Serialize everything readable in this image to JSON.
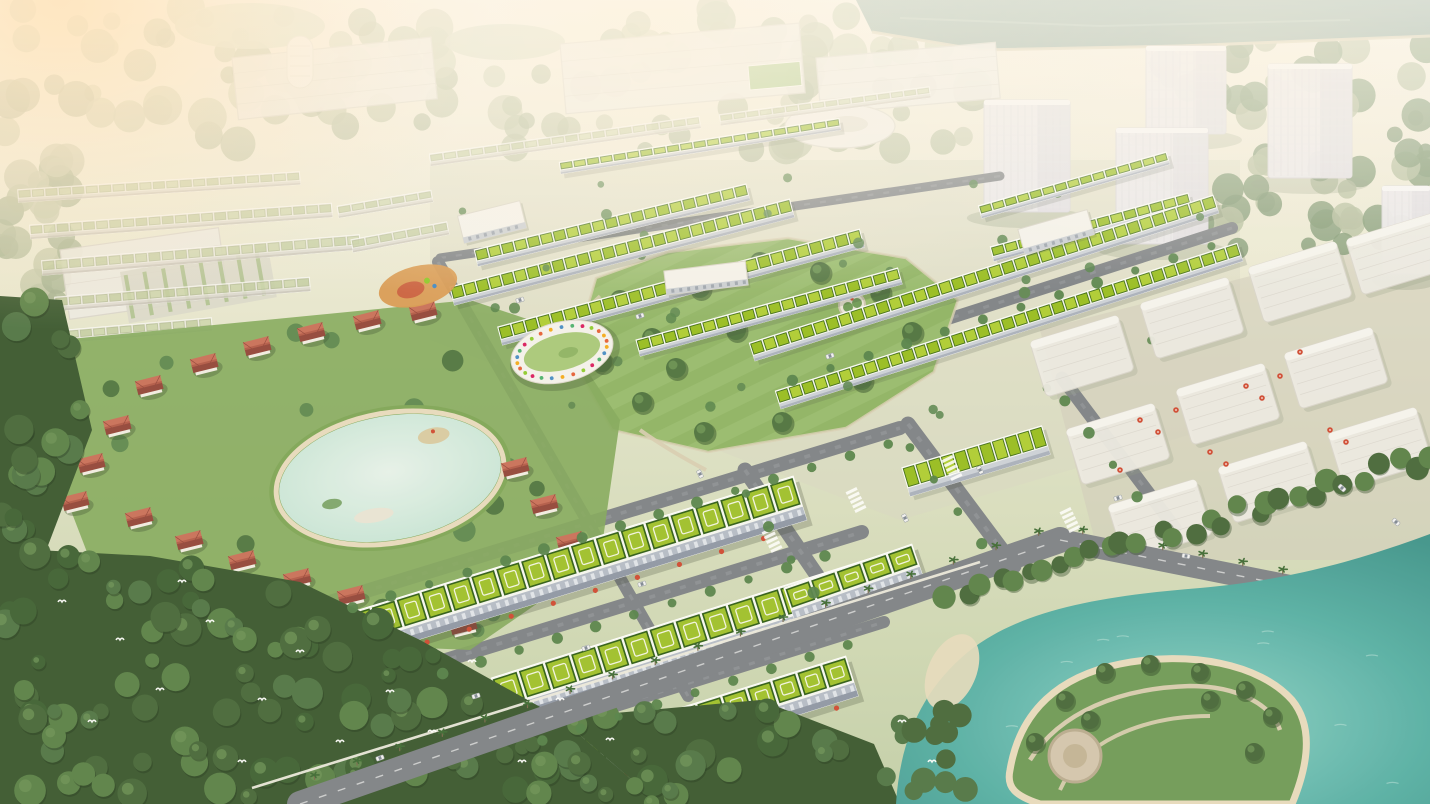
{
  "scene": {
    "title": "Aerial 3D masterplan rendering of a green township development",
    "lighting": "hazy warm sunlight from upper left",
    "palette": {
      "sky_top": "#f6efe0",
      "ground_a": "#e9e8d2",
      "ground_b": "#d5dcbc",
      "ground_c": "#c3cfa9",
      "haze_warm": "#ffe3ba",
      "haze_soft": "#fff2da",
      "river": "#87a497",
      "river_bank": "#d9cdb2",
      "canopy_wash_a": "#c3c8ab",
      "canopy_wash_b": "#b2bc9c",
      "canopy_wash_c": "#a4b292",
      "ghost_fill": "#edebe5",
      "ghost_edge": "#d9d5cd",
      "tower_fill": "#ebe9ed",
      "tower_edge": "#d8d6db",
      "tower_shade": "#dedce2",
      "roof_green_light": "#aecd33",
      "roof_green": "#97bd20",
      "roof_green_dark": "#3f6d15",
      "roof_deck": "#f6f7f2",
      "facade": "#ccd1d9",
      "facade_dark": "#a9b0bd",
      "mega_roof": "#9fc02c",
      "mega_roof_dark": "#2f5d17",
      "mega_facade": "#b5bcc8",
      "mega_facade_dark": "#8f97a6",
      "villa_roof": "#b35b49",
      "villa_roof_light": "#c9705a",
      "villa_roof_dark": "#93463a",
      "villa_wall": "#f1ece3",
      "lawn": "#8fb465",
      "lawn_light": "#9cc074",
      "park_tree": "#4e7340",
      "tree_mid": "#55824a",
      "forest_base": "#3a5830",
      "forest_mid": "#47683a",
      "forest_light": "#5a8148",
      "pond_light": "#e6f2ea",
      "pond": "#c2e2d4",
      "lake_light": "#8ed2c8",
      "lake": "#57b0a6",
      "lake_deep": "#3f948c",
      "beach": "#e7dbbe",
      "road": "#7e8287",
      "road_light": "#979ba0",
      "path": "#d8cdb2",
      "wall": "#eceade",
      "umbrella": "#cf4a33",
      "car_light": "#f2f2f2",
      "bird": "#ffffff",
      "kindergarten_ring": [
        "#e4572e",
        "#f3a712",
        "#3f88c5",
        "#44af69",
        "#d81159",
        "#8ac926"
      ]
    },
    "river": {
      "points": [
        [
          856,
          0
        ],
        [
          1430,
          0
        ],
        [
          1430,
          36
        ],
        [
          1180,
          46
        ],
        [
          980,
          50
        ],
        [
          872,
          32
        ]
      ]
    },
    "top_left_ponds": [
      [
        250,
        26,
        150,
        46
      ],
      [
        505,
        42,
        120,
        36
      ]
    ],
    "ghost_campus": [
      {
        "x": 232,
        "y": 58,
        "w": 200,
        "h": 62,
        "angle": -6
      },
      {
        "x": 560,
        "y": 44,
        "w": 240,
        "h": 70,
        "angle": -5
      },
      {
        "x": 816,
        "y": 58,
        "w": 180,
        "h": 56,
        "angle": -5
      },
      {
        "x": 60,
        "y": 250,
        "w": 160,
        "h": 70,
        "angle": -8
      }
    ],
    "sports_field": {
      "x": 748,
      "y": 66,
      "w": 52,
      "h": 24,
      "angle": -5
    },
    "curved_building": {
      "cx": 840,
      "cy": 126,
      "rx": 55,
      "ry": 22
    },
    "round_tower": {
      "x": 287,
      "y": 36,
      "w": 26,
      "h": 52
    },
    "parking_lot": {
      "x": 120,
      "y": 272,
      "w": 150,
      "h": 52,
      "angle": -10
    },
    "ghost_towers": [
      [
        984,
        100,
        86,
        112
      ],
      [
        1146,
        46,
        80,
        88
      ],
      [
        1116,
        128,
        92,
        116
      ],
      [
        1268,
        64,
        84,
        114
      ],
      [
        1382,
        186,
        48,
        88
      ]
    ],
    "ghost_rows": [
      [
        18,
        196,
        300,
        178,
        13
      ],
      [
        30,
        232,
        332,
        210,
        14
      ],
      [
        42,
        268,
        360,
        242,
        15
      ],
      [
        55,
        304,
        310,
        284,
        14
      ],
      [
        0,
        342,
        212,
        324,
        13
      ],
      [
        338,
        212,
        432,
        196,
        12
      ],
      [
        352,
        246,
        448,
        228,
        13
      ],
      [
        430,
        160,
        700,
        122,
        12
      ],
      [
        720,
        120,
        930,
        92,
        11
      ]
    ],
    "green_rows": [
      [
        560,
        168,
        840,
        124,
        12
      ],
      [
        476,
        258,
        748,
        192,
        17
      ],
      [
        452,
        296,
        792,
        208,
        19
      ],
      [
        500,
        336,
        862,
        238,
        19
      ],
      [
        638,
        348,
        900,
        276,
        17
      ],
      [
        980,
        212,
        1168,
        158,
        13
      ],
      [
        992,
        254,
        1190,
        200,
        15
      ],
      [
        752,
        352,
        1216,
        204,
        19
      ],
      [
        778,
        400,
        1240,
        252,
        19
      ],
      [
        906,
        482,
        1046,
        440,
        30
      ]
    ],
    "mega_blocks": [
      [
        352,
        636,
        800,
        498,
        46
      ],
      [
        498,
        700,
        916,
        568,
        46
      ],
      [
        552,
        770,
        852,
        676,
        42
      ],
      [
        790,
        606,
        918,
        562,
        38
      ]
    ],
    "roads": [
      [
        330,
        602,
        900,
        428,
        14
      ],
      [
        420,
        668,
        862,
        532,
        14
      ],
      [
        520,
        736,
        884,
        622,
        12
      ],
      [
        770,
        376,
        1232,
        228,
        12
      ],
      [
        745,
        470,
        842,
        612,
        15
      ],
      [
        908,
        424,
        1014,
        566,
        15
      ],
      [
        1062,
        378,
        1175,
        528,
        13
      ],
      [
        440,
        258,
        1000,
        176,
        9
      ],
      [
        438,
        262,
        688,
        696,
        12
      ]
    ],
    "boulevard": {
      "a": [
        300,
        804,
        1060,
        540,
        26
      ],
      "b": [
        1060,
        540,
        1430,
        614,
        22
      ],
      "wall": [
        252,
        788,
        980,
        562
      ]
    },
    "central_park": {
      "points": [
        [
          596,
          278
        ],
        [
          668,
          252
        ],
        [
          788,
          238
        ],
        [
          906,
          258
        ],
        [
          958,
          300
        ],
        [
          934,
          372
        ],
        [
          846,
          428
        ],
        [
          708,
          452
        ],
        [
          612,
          430
        ],
        [
          572,
          360
        ]
      ],
      "trees": [
        [
          620,
          300
        ],
        [
          652,
          338
        ],
        [
          700,
          288
        ],
        [
          760,
          262
        ],
        [
          820,
          272
        ],
        [
          880,
          292
        ],
        [
          912,
          332
        ],
        [
          862,
          380
        ],
        [
          782,
          422
        ],
        [
          704,
          432
        ],
        [
          642,
          402
        ],
        [
          602,
          362
        ],
        [
          736,
          330
        ],
        [
          676,
          368
        ]
      ],
      "hedge_garden": [
        852,
        305
      ]
    },
    "white_buildings": [
      {
        "x": 492,
        "y": 222,
        "w": 64,
        "h": 28,
        "angle": -14
      },
      {
        "x": 706,
        "y": 278,
        "w": 82,
        "h": 24,
        "angle": -7
      },
      {
        "x": 1056,
        "y": 232,
        "w": 72,
        "h": 26,
        "angle": -16
      }
    ],
    "kindergarten": {
      "cx": 562,
      "cy": 352,
      "rx": 52,
      "ry": 30,
      "angle": -14
    },
    "playground": {
      "cx": 418,
      "cy": 286,
      "rx": 40,
      "ry": 20,
      "angle": -14
    },
    "villa_pond": {
      "cx": 390,
      "cy": 478,
      "rx": 112,
      "ry": 62,
      "angle": -10
    },
    "villa_lawn": [
      [
        60,
        340
      ],
      [
        470,
        300
      ],
      [
        560,
        330
      ],
      [
        620,
        420
      ],
      [
        600,
        560
      ],
      [
        470,
        650
      ],
      [
        240,
        640
      ],
      [
        90,
        560
      ],
      [
        40,
        430
      ]
    ],
    "villas": [
      [
        150,
        388
      ],
      [
        205,
        366
      ],
      [
        258,
        349
      ],
      [
        312,
        335
      ],
      [
        368,
        323
      ],
      [
        424,
        314
      ],
      [
        118,
        428
      ],
      [
        92,
        466
      ],
      [
        76,
        504
      ],
      [
        140,
        520
      ],
      [
        190,
        543
      ],
      [
        243,
        563
      ],
      [
        298,
        581
      ],
      [
        352,
        598
      ],
      [
        408,
        612
      ],
      [
        464,
        628
      ],
      [
        516,
        470
      ],
      [
        545,
        507
      ],
      [
        571,
        544
      ]
    ],
    "forest": {
      "main": [
        [
          0,
          548
        ],
        [
          150,
          556
        ],
        [
          300,
          582
        ],
        [
          420,
          640
        ],
        [
          560,
          718
        ],
        [
          660,
          804
        ],
        [
          0,
          804
        ]
      ],
      "left_band": [
        [
          0,
          296
        ],
        [
          62,
          300
        ],
        [
          92,
          430
        ],
        [
          44,
          556
        ],
        [
          0,
          556
        ]
      ],
      "wedge": [
        [
          560,
          718
        ],
        [
          660,
          804
        ],
        [
          900,
          804
        ],
        [
          874,
          744
        ],
        [
          760,
          700
        ]
      ]
    },
    "ghost_blocks": [
      [
        1082,
        356
      ],
      [
        1192,
        318
      ],
      [
        1300,
        282
      ],
      [
        1398,
        254
      ],
      [
        1118,
        444
      ],
      [
        1228,
        404
      ],
      [
        1336,
        368
      ],
      [
        1160,
        520
      ],
      [
        1270,
        482
      ],
      [
        1380,
        448
      ]
    ],
    "plaza_umbrellas": [
      [
        1140,
        420
      ],
      [
        1158,
        432
      ],
      [
        1176,
        410
      ],
      [
        1246,
        386
      ],
      [
        1262,
        398
      ],
      [
        1280,
        376
      ],
      [
        1210,
        452
      ],
      [
        1226,
        464
      ],
      [
        1120,
        470
      ],
      [
        1330,
        430
      ],
      [
        1346,
        442
      ],
      [
        1300,
        352
      ]
    ],
    "lake": {
      "outline": "M896,804 C900,740 922,690 968,652 C1020,610 1100,596 1200,588 C1290,580 1360,560 1430,534 L1430,804 Z",
      "island": "M1010,770 C1020,710 1060,676 1120,664 C1190,650 1260,664 1292,700 C1310,722 1312,756 1292,804 L1040,804 C1016,796 1006,788 1010,770 Z",
      "plaza": [
        1075,
        756
      ],
      "beach_cove": [
        952,
        672
      ],
      "tree_line": [
        [
          950,
          600
        ],
        [
          1430,
          455
        ]
      ],
      "island_trees": [
        [
          1035,
          742
        ],
        [
          1065,
          700
        ],
        [
          1105,
          672
        ],
        [
          1150,
          664
        ],
        [
          1200,
          672
        ],
        [
          1245,
          690
        ],
        [
          1272,
          716
        ],
        [
          1254,
          752
        ],
        [
          1210,
          700
        ],
        [
          1090,
          720
        ]
      ]
    },
    "crosswalks": [
      [
        856,
        500,
        64
      ],
      [
        952,
        468,
        64
      ],
      [
        1070,
        520,
        64
      ],
      [
        772,
        540,
        64
      ]
    ],
    "cars": [
      [
        476,
        696,
        -17
      ],
      [
        586,
        648,
        -17
      ],
      [
        642,
        584,
        -17
      ],
      [
        905,
        518,
        64
      ],
      [
        1118,
        498,
        -17
      ],
      [
        700,
        474,
        64
      ],
      [
        1186,
        556,
        8
      ],
      [
        830,
        356,
        -17
      ],
      [
        640,
        316,
        -17
      ],
      [
        380,
        758,
        -19
      ],
      [
        1396,
        522,
        42
      ],
      [
        1342,
        488,
        42
      ],
      [
        520,
        300,
        -17
      ],
      [
        980,
        470,
        64
      ]
    ],
    "egrets": [
      [
        120,
        640
      ],
      [
        160,
        690
      ],
      [
        210,
        622
      ],
      [
        262,
        700
      ],
      [
        300,
        652
      ],
      [
        340,
        742
      ],
      [
        92,
        722
      ],
      [
        390,
        692
      ],
      [
        242,
        762
      ],
      [
        432,
        732
      ],
      [
        182,
        582
      ],
      [
        62,
        602
      ],
      [
        522,
        762
      ],
      [
        472,
        662
      ],
      [
        560,
        700
      ],
      [
        610,
        740
      ],
      [
        902,
        722
      ],
      [
        932,
        762
      ]
    ]
  }
}
